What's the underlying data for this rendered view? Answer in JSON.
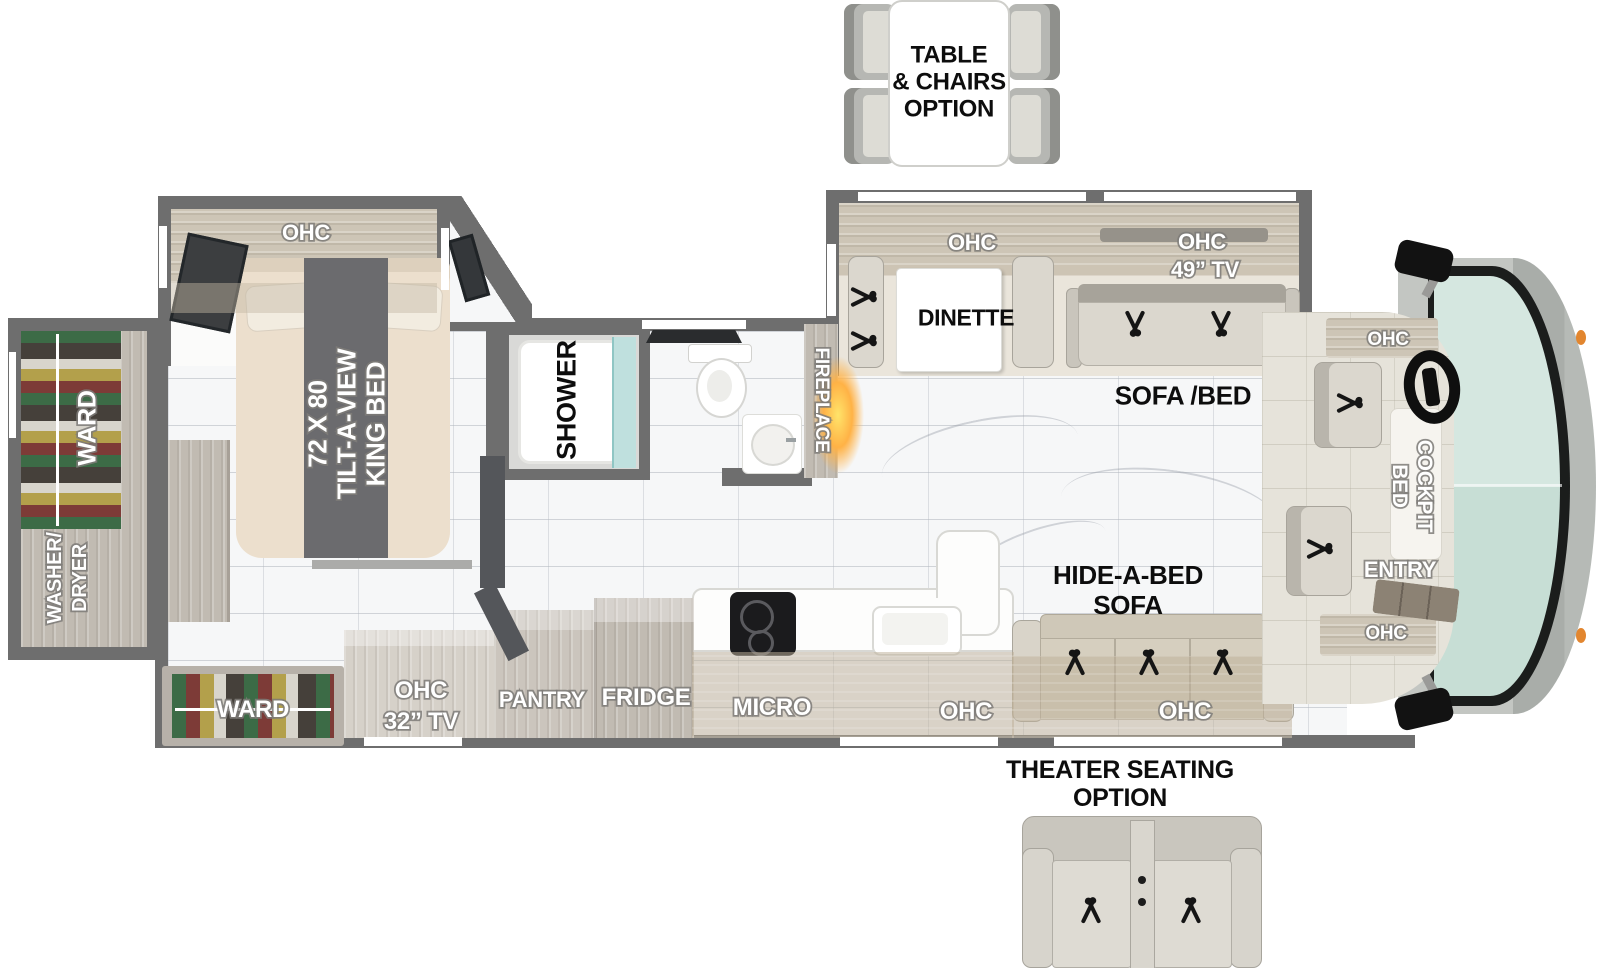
{
  "title": "Class A motorhome floor plan",
  "colors": {
    "wall": "#6e6e6e",
    "floor": "#f6f7f8",
    "wood": "#c6c0b7",
    "windshield": "#cfe3da",
    "fireplace_glow": "#ffb246",
    "marker_light": "#e2862f"
  },
  "options": {
    "table_chairs": {
      "lines": [
        "TABLE",
        "& CHAIRS",
        "OPTION"
      ]
    },
    "theater": {
      "lines": [
        "THEATER SEATING",
        "OPTION"
      ]
    }
  },
  "bedroom": {
    "ohc": "OHC",
    "bed": {
      "lines": [
        "72 X 80",
        "TILT-A-VIEW",
        "KING BED"
      ]
    }
  },
  "rear": {
    "ward": "WARD",
    "washer": {
      "lines": [
        "WASHER/",
        "DRYER"
      ]
    }
  },
  "bath": {
    "shower": "SHOWER",
    "fireplace": "FIREPLACE"
  },
  "living": {
    "ohc_dinette": "OHC",
    "dinette": "DINETTE",
    "ohc_tv": "OHC",
    "tv": "49” TV",
    "sofa_bed": "SOFA /BED",
    "hide_a_bed": {
      "lines": [
        "HIDE-A-BED",
        "SOFA"
      ]
    },
    "ohc_hide": "OHC"
  },
  "kitchen": {
    "micro": "MICRO",
    "ohc_sink": "OHC",
    "fridge": "FRIDGE",
    "pantry": "PANTRY",
    "ohc_tv": {
      "lines": [
        "OHC",
        "32” TV"
      ]
    },
    "ward": "WARD"
  },
  "cab": {
    "ohc_top": "OHC",
    "cockpit": {
      "lines": [
        "COCKPIT",
        "BED"
      ]
    },
    "entry": "ENTRY",
    "ohc_bottom": "OHC"
  }
}
